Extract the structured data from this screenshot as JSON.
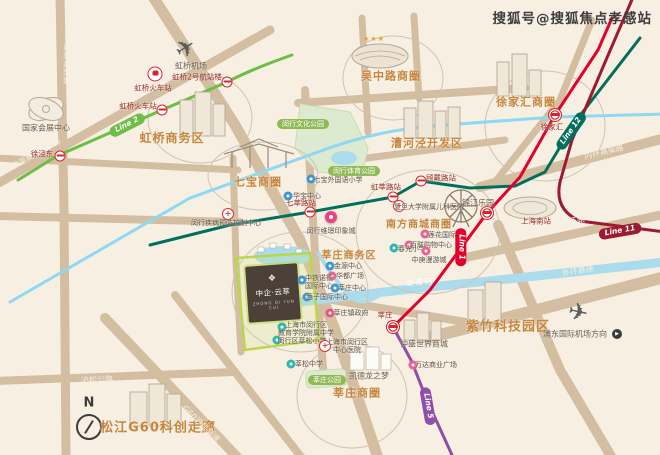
{
  "watermark": {
    "text": "搜狐号@搜狐焦点孝感站"
  },
  "compass": {
    "label": "N"
  },
  "project": {
    "name": "中企·云萃",
    "sub": "ZHONG QI YUN CUI",
    "logo": "❖"
  },
  "decor": {
    "stadium_stars": "★★★"
  },
  "poi_colors": {
    "school": "#3e97d1",
    "schoolt": "#2cb8ac",
    "office": "#3e97d1",
    "mall": "#ee5f8e",
    "gov": "#e8537f",
    "pin": "#e8437f"
  },
  "districts": [
    {
      "label": "吴中路商圈",
      "x": 391,
      "y": 77,
      "fs": 11
    },
    {
      "label": "徐家汇商圈",
      "x": 526,
      "y": 103,
      "fs": 11
    },
    {
      "label": "虹桥商务区",
      "x": 172,
      "y": 139,
      "fs": 12
    },
    {
      "label": "漕河泾开发区",
      "x": 427,
      "y": 144,
      "fs": 11
    },
    {
      "label": "七宝商圈",
      "x": 258,
      "y": 183,
      "fs": 11
    },
    {
      "label": "南方商城商圈",
      "x": 419,
      "y": 225,
      "fs": 10
    },
    {
      "label": "莘庄商务区",
      "x": 349,
      "y": 256,
      "fs": 10
    },
    {
      "label": "紫竹科技园区",
      "x": 508,
      "y": 328,
      "fs": 13
    },
    {
      "label": "莘庄商圈",
      "x": 357,
      "y": 394,
      "fs": 11
    },
    {
      "label": "松江G60科创走廊",
      "x": 158,
      "y": 429,
      "fs": 13
    }
  ],
  "park_pills": [
    {
      "label": "闵行文化公园",
      "x": 303,
      "y": 124
    },
    {
      "label": "闵行体育公园",
      "x": 354,
      "y": 171
    },
    {
      "label": "莘庄公园",
      "x": 327,
      "y": 380
    }
  ],
  "stations": [
    {
      "label": "虹桥火车站",
      "type": "rail",
      "cx": 155,
      "cy": 74,
      "lx": 153,
      "ly": 89
    },
    {
      "label": "虹桥火车站",
      "type": "station",
      "cx": 162,
      "cy": 110,
      "lx": 138,
      "ly": 107
    },
    {
      "label": "虹桥2号航站楼",
      "type": "station",
      "cx": 227,
      "cy": 82,
      "lx": 197,
      "ly": 78
    },
    {
      "label": "徐泾东",
      "type": "station",
      "cx": 60,
      "cy": 156,
      "lx": 42,
      "ly": 155
    },
    {
      "label": "七莘路站",
      "type": "station",
      "cx": 310,
      "cy": 212,
      "lx": 301,
      "ly": 204
    },
    {
      "label": "虹莘路站",
      "type": "station",
      "cx": 393,
      "cy": 197,
      "lx": 386,
      "ly": 188
    },
    {
      "label": "顾戴路站",
      "type": "station",
      "cx": 421,
      "cy": 181,
      "lx": 441,
      "ly": 179
    },
    {
      "label": "徐家汇",
      "type": "hub",
      "cx": 555,
      "cy": 115,
      "lx": 552,
      "ly": 128
    },
    {
      "label": "上海南站",
      "type": "hub",
      "cx": 487,
      "cy": 213,
      "lx": 536,
      "ly": 222
    },
    {
      "label": "莘庄",
      "type": "hub",
      "cx": 393,
      "cy": 327,
      "lx": 385,
      "ly": 316
    }
  ],
  "pois": [
    {
      "type": "school",
      "label": "七宝外国语小学",
      "ix": 311,
      "iy": 179,
      "x": 338,
      "y": 180
    },
    {
      "type": "office",
      "label": "华宝中心",
      "ix": 288,
      "iy": 196,
      "x": 307,
      "y": 196
    },
    {
      "type": "hospital",
      "label": "闵行疾病预防控制中心",
      "ix": 228,
      "iy": 214,
      "x": 226,
      "y": 223
    },
    {
      "type": "pin",
      "label": "闵行维璟印象城",
      "ix": 331,
      "iy": 217,
      "x": 331,
      "y": 231
    },
    {
      "type": "hospital",
      "label": "复旦大学附属儿科医院",
      "ix": 399,
      "iy": 206,
      "x": 429,
      "y": 207
    },
    {
      "type": "mall",
      "label": "莲花国际",
      "ix": 425,
      "iy": 234,
      "x": 442,
      "y": 235
    },
    {
      "type": "mall",
      "label": "百联购物中心",
      "ix": 409,
      "iy": 245,
      "x": 431,
      "y": 245
    },
    {
      "type": "schoolt",
      "label": "春光小学",
      "ix": 394,
      "iy": 248,
      "x": 412,
      "y": 249
    },
    {
      "type": "mall",
      "label": "中庚漫游城",
      "ix": 426,
      "iy": 251,
      "x": 429,
      "y": 260
    },
    {
      "type": "office",
      "label": "金源中心",
      "ix": 330,
      "iy": 266,
      "x": 348,
      "y": 266
    },
    {
      "type": "mall",
      "label": "华都广场",
      "ix": 332,
      "iy": 276,
      "x": 350,
      "y": 276
    },
    {
      "type": "office",
      "label": "中铁诺德\n国际中心",
      "ix": 302,
      "iy": 280,
      "x": 319,
      "y": 282
    },
    {
      "type": "office",
      "label": "莘庄中心",
      "ix": 335,
      "iy": 288,
      "x": 352,
      "y": 288
    },
    {
      "type": "office",
      "label": "西子国际中心",
      "ix": 307,
      "iy": 297,
      "x": 327,
      "y": 297
    },
    {
      "type": "gov",
      "label": "莘庄镇政府",
      "ix": 330,
      "iy": 313,
      "x": 351,
      "y": 313
    },
    {
      "type": "schoolt",
      "label": "上海市闵行区\n教育学院附属中学",
      "ix": 282,
      "iy": 327,
      "x": 306,
      "y": 329
    },
    {
      "type": "schoolt",
      "label": "闵行区莘松小学",
      "ix": 277,
      "iy": 340,
      "x": 302,
      "y": 341
    },
    {
      "type": "schoolt",
      "label": "莘松中学",
      "ix": 291,
      "iy": 364,
      "x": 309,
      "y": 364
    },
    {
      "type": "hospital",
      "label": "上海市闵行区\n中心医院",
      "ix": 325,
      "iy": 346,
      "x": 347,
      "y": 346
    },
    {
      "type": "mall",
      "label": "万达商业广场",
      "ix": 413,
      "iy": 365,
      "x": 436,
      "y": 365
    }
  ],
  "landmarks": [
    {
      "label": "国家会展中心",
      "x": 46,
      "y": 128
    },
    {
      "label": "锦江乐园",
      "x": 478,
      "y": 203
    },
    {
      "label": "凯德龙之梦",
      "x": 369,
      "y": 376
    },
    {
      "label": "仲盛世界商城",
      "x": 424,
      "y": 344
    }
  ],
  "airports": [
    {
      "label": "虹桥机场",
      "x": 191,
      "y": 66,
      "px": 186,
      "py": 49,
      "rot": -32
    },
    {
      "label": "浦东国际机场方向",
      "x": 575,
      "y": 334,
      "px": 578,
      "py": 313,
      "rot": 12,
      "arrow": "▶",
      "ax": 617,
      "ay": 334
    }
  ],
  "road_labels": [
    {
      "text": "嘉闵高架路",
      "x": 66,
      "y": 64,
      "vertical": true
    },
    {
      "text": "沪渝高速(G50)",
      "x": 36,
      "y": 154,
      "rot": -29
    },
    {
      "text": "内环高架路",
      "x": 604,
      "y": 152,
      "rot": -13
    },
    {
      "text": "中环路",
      "x": 573,
      "y": 221,
      "rot": -9
    },
    {
      "text": "外环高速",
      "x": 578,
      "y": 271,
      "rot": -11
    },
    {
      "text": "沪松公路",
      "x": 97,
      "y": 380,
      "rot": -2
    },
    {
      "text": "G60沪昆高速",
      "x": 201,
      "y": 424,
      "rot": 44
    }
  ],
  "water_labels": [
    {
      "text": "淀浦河",
      "x": 420,
      "y": 283,
      "rot": -4
    }
  ],
  "metro_pills": [
    {
      "text": "Line 2",
      "x": 127,
      "y": 125,
      "rot": -27,
      "color": "#6cbe45"
    },
    {
      "text": "Line 12",
      "x": 571,
      "y": 131,
      "rot": -55,
      "color": "#00705c"
    },
    {
      "text": "Line 1",
      "x": 461,
      "y": 247,
      "rot": 90,
      "color": "#e3002b"
    },
    {
      "text": "Line 5",
      "x": 428,
      "y": 406,
      "rot": 80,
      "color": "#8f4fa8"
    },
    {
      "text": "Line 11",
      "x": 620,
      "y": 231,
      "rot": -10,
      "color": "#9b1b30"
    }
  ]
}
